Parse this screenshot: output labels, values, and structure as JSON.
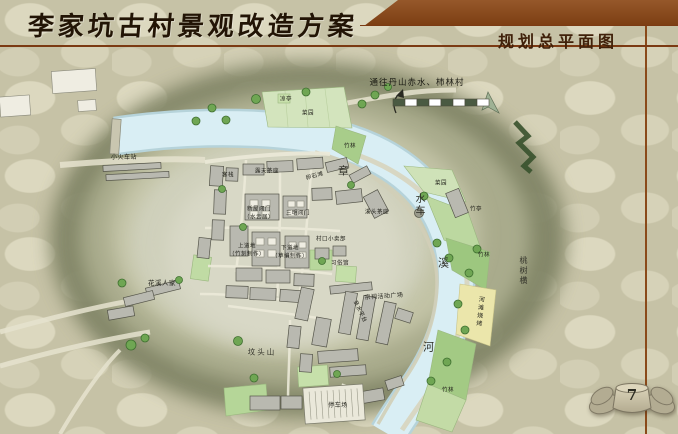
{
  "header": {
    "title": "李家坑古村景观改造方案",
    "section_label": "规划总平面图"
  },
  "footer": {
    "page_number": "7"
  },
  "colors": {
    "accent_brown": "#8a4a1a",
    "river_blue": "#d9eef4",
    "hill_olive": "#7e8263",
    "garden_green": "#9dc77f",
    "beach_yellow": "#ebe6ab"
  },
  "icons": {
    "north_arrow": "north-arrow",
    "scale_bar": "scale-bar",
    "direction_arrow": "curved-up-arrow",
    "page_emblem": "winged-stone-emblem"
  },
  "map": {
    "labels": [
      {
        "text": "通往丹山赤水、柿林村",
        "x": 417,
        "y": 83,
        "size": 8.5,
        "cls": "note"
      },
      {
        "text": "小火车站",
        "x": 124,
        "y": 158,
        "size": 6
      },
      {
        "text": "凉亭",
        "x": 286,
        "y": 100,
        "size": 5.5
      },
      {
        "text": "菜园",
        "x": 308,
        "y": 114,
        "size": 5.5
      },
      {
        "text": "竹林",
        "x": 350,
        "y": 147,
        "size": 5.5
      },
      {
        "text": "卵石滩",
        "x": 315,
        "y": 177,
        "size": 5.5,
        "rotate": -16
      },
      {
        "text": "客栈",
        "x": 228,
        "y": 176,
        "size": 5.5
      },
      {
        "text": "露天茶座",
        "x": 267,
        "y": 172,
        "size": 5.5
      },
      {
        "text": "新屋阊门",
        "x": 259,
        "y": 210,
        "size": 5.5
      },
      {
        "text": "（水云居）",
        "x": 259,
        "y": 218,
        "size": 5.5
      },
      {
        "text": "三明阊门",
        "x": 298,
        "y": 214,
        "size": 5.5
      },
      {
        "text": "溪头茶座",
        "x": 377,
        "y": 213,
        "size": 5.5
      },
      {
        "text": "菜园",
        "x": 441,
        "y": 184,
        "size": 5.5
      },
      {
        "text": "竹亭",
        "x": 476,
        "y": 210,
        "size": 5.5
      },
      {
        "text": "竹林",
        "x": 484,
        "y": 256,
        "size": 5.5
      },
      {
        "text": "上道地",
        "x": 247,
        "y": 247,
        "size": 5.5
      },
      {
        "text": "（竹刻制作）",
        "x": 247,
        "y": 255,
        "size": 5.5
      },
      {
        "text": "下道地",
        "x": 290,
        "y": 249,
        "size": 5.5
      },
      {
        "text": "（草编制作）",
        "x": 290,
        "y": 257,
        "size": 5.5
      },
      {
        "text": "村口小卖部",
        "x": 331,
        "y": 240,
        "size": 5.5
      },
      {
        "text": "习俗馆",
        "x": 340,
        "y": 264,
        "size": 5.5
      },
      {
        "text": "花溪人家",
        "x": 162,
        "y": 283,
        "size": 6.5
      },
      {
        "text": "坟头山",
        "x": 262,
        "y": 352,
        "size": 7.5,
        "cls": "hill"
      },
      {
        "text": "宗祠活动广场",
        "x": 384,
        "y": 297,
        "size": 6,
        "rotate": -4
      },
      {
        "text": "亲水平台",
        "x": 359,
        "y": 312,
        "size": 5.5,
        "rotate": 64
      },
      {
        "text": "河滩烧烤",
        "x": 479,
        "y": 312,
        "size": 6,
        "vertical": true,
        "rotate": 6
      },
      {
        "text": "桃树横",
        "x": 523,
        "y": 271,
        "size": 8,
        "vertical": true,
        "cls": "hill"
      },
      {
        "text": "竹林",
        "x": 448,
        "y": 391,
        "size": 5.5
      },
      {
        "text": "停车场",
        "x": 338,
        "y": 406,
        "size": 6
      },
      {
        "text": "章",
        "x": 344,
        "y": 171,
        "size": 11,
        "cls": "river"
      },
      {
        "text": "水",
        "x": 421,
        "y": 200,
        "size": 10,
        "cls": "river"
      },
      {
        "text": "车",
        "x": 421,
        "y": 212,
        "size": 10,
        "cls": "river"
      },
      {
        "text": "溪",
        "x": 444,
        "y": 263,
        "size": 11,
        "cls": "river"
      },
      {
        "text": "河",
        "x": 429,
        "y": 347,
        "size": 11,
        "cls": "river"
      }
    ]
  }
}
